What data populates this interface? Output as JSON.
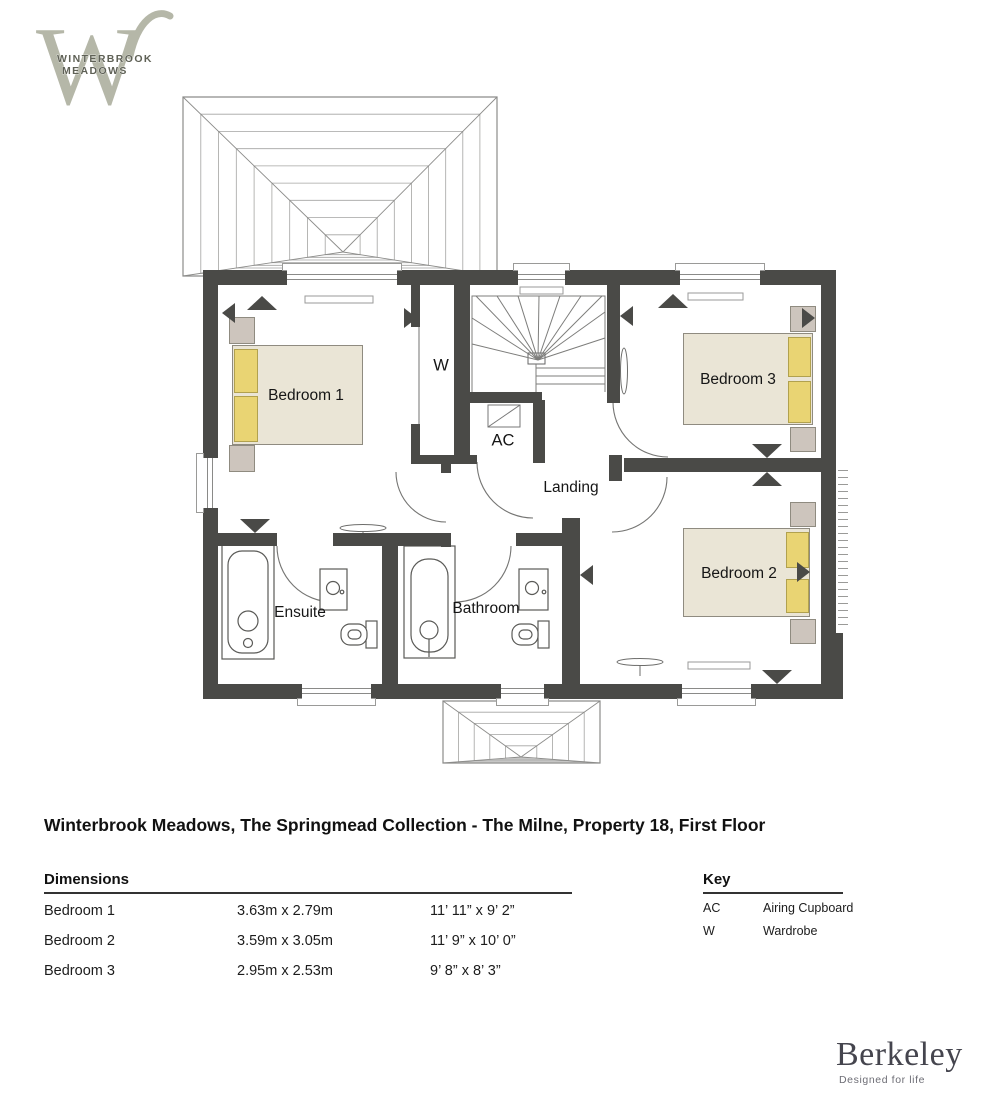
{
  "logo": {
    "line1": "WINTERBROOK",
    "line2": "MEADOWS"
  },
  "floorplan": {
    "rooms": {
      "bedroom1": "Bedroom 1",
      "bedroom2": "Bedroom 2",
      "bedroom3": "Bedroom 3",
      "landing": "Landing",
      "ensuite": "Ensuite",
      "bathroom": "Bathroom"
    },
    "markers": {
      "wardrobe": "W",
      "airing_cupboard": "AC"
    }
  },
  "title": "Winterbrook Meadows, The Springmead Collection - The Milne, Property 18, First Floor",
  "dimensions": {
    "heading": "Dimensions",
    "rows": [
      {
        "room": "Bedroom 1",
        "metric": "3.63m x 2.79m",
        "imperial": "11’ 11” x 9’ 2”"
      },
      {
        "room": "Bedroom 2",
        "metric": "3.59m x 3.05m",
        "imperial": "11’ 9” x 10’ 0”"
      },
      {
        "room": "Bedroom 3",
        "metric": "2.95m x 2.53m",
        "imperial": "9’ 8” x 8’ 3”"
      }
    ]
  },
  "key": {
    "heading": "Key",
    "rows": [
      {
        "abbr": "AC",
        "label": "Airing Cupboard"
      },
      {
        "abbr": "W",
        "label": "Wardrobe"
      }
    ]
  },
  "footer": {
    "brand": "Berkeley",
    "tagline": "Designed for life"
  },
  "colors": {
    "wall": "#4a4a47",
    "bed": "#eae5d6",
    "pillow": "#e9d473",
    "side_table": "#cdc5bd",
    "logo_mark": "#b5b7a8"
  }
}
